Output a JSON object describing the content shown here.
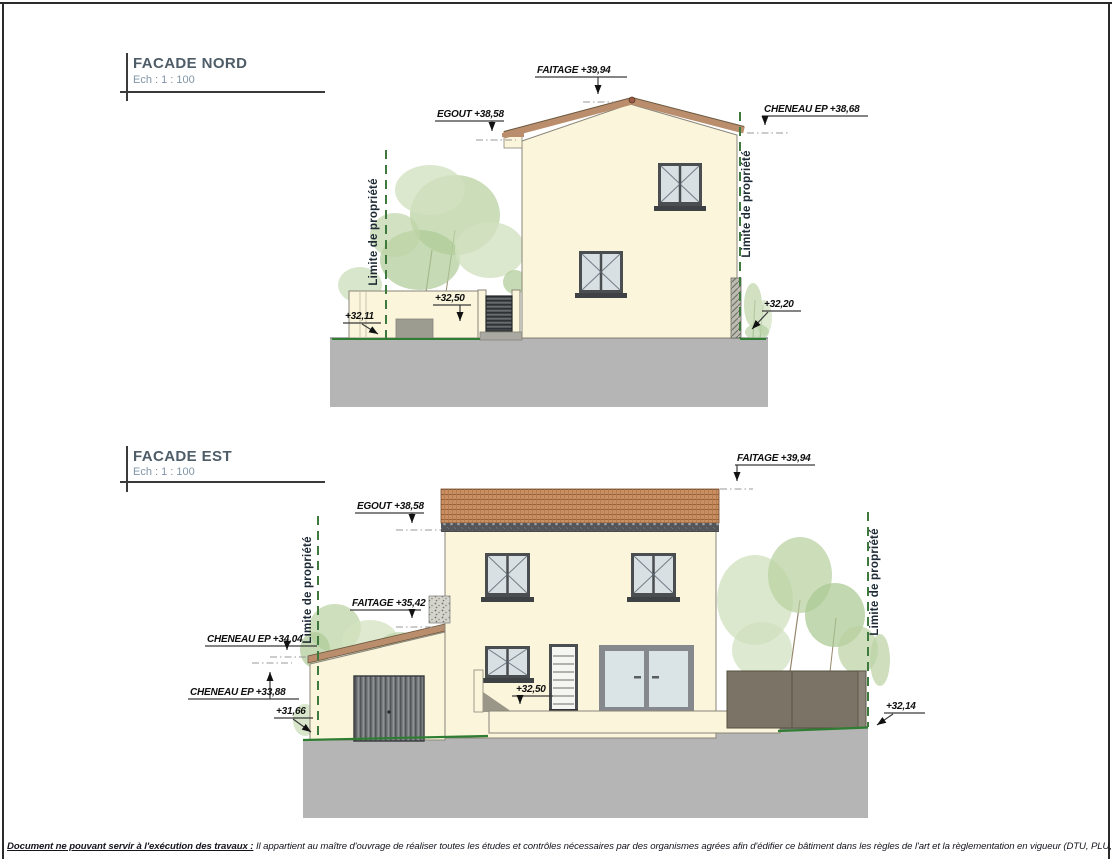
{
  "page": {
    "footer": {
      "lead": "Document ne pouvant servir à l'exécution des travaux :",
      "rest": " Il appartient au maître  d'ouvrage de réaliser toutes les études et contrôles nécessaires par des organismes agrées afin d'édifier ce bâtiment dans les règles de l'art et la règlementation en vigueur (DTU, PLU,...)."
    }
  },
  "facade_nord": {
    "title": "FACADE NORD",
    "scale_label": "Ech :  1 : 100",
    "ann": {
      "faitage": "FAITAGE +39,94",
      "egout": "EGOUT +38,58",
      "cheneau_ep": "CHENEAU EP +38,68",
      "limite_left": "Limite de propriété",
      "limite_right": "Limite de propriété",
      "lvl_32_11": "+32,11",
      "lvl_32_50": "+32,50",
      "lvl_32_20": "+32,20"
    }
  },
  "facade_est": {
    "title": "FACADE EST",
    "scale_label": "Ech :  1 : 100",
    "ann": {
      "faitage_main": "FAITAGE +39,94",
      "egout": "EGOUT +38,58",
      "faitage_annex": "FAITAGE +35,42",
      "cheneau_ep_high": "CHENEAU EP +34,04",
      "cheneau_ep_low": "CHENEAU EP +33,88",
      "lvl_31_66": "+31,66",
      "lvl_32_50": "+32,50",
      "lvl_32_14": "+32,14",
      "limite_left": "Limite de propriété",
      "limite_right": "Limite de propriété"
    }
  },
  "colors": {
    "wall_cream": "#FAF5DB",
    "roof_brown": "#BA8E6C",
    "tile_base": "#C98E62",
    "ground_gray": "#B5B5B5",
    "property_line_green": "#3E7A3E",
    "terrain_green": "#2F7D32",
    "frame_dark": "#4b4e50",
    "fence_taupe": "#7B7466"
  }
}
